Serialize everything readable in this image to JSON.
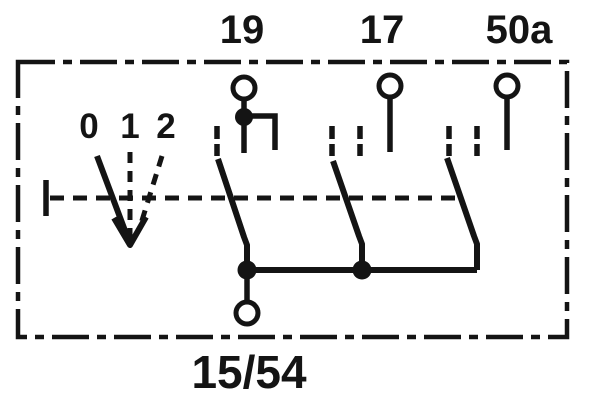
{
  "diagram": {
    "colors": {
      "ink": "#141414",
      "background": "#ffffff"
    },
    "terminals_top": [
      {
        "label": "19"
      },
      {
        "label": "17"
      },
      {
        "label": "50a"
      }
    ],
    "terminal_bottom": {
      "label": "15/54"
    },
    "switch_positions": [
      {
        "label": "0"
      },
      {
        "label": "1"
      },
      {
        "label": "2"
      }
    ]
  }
}
